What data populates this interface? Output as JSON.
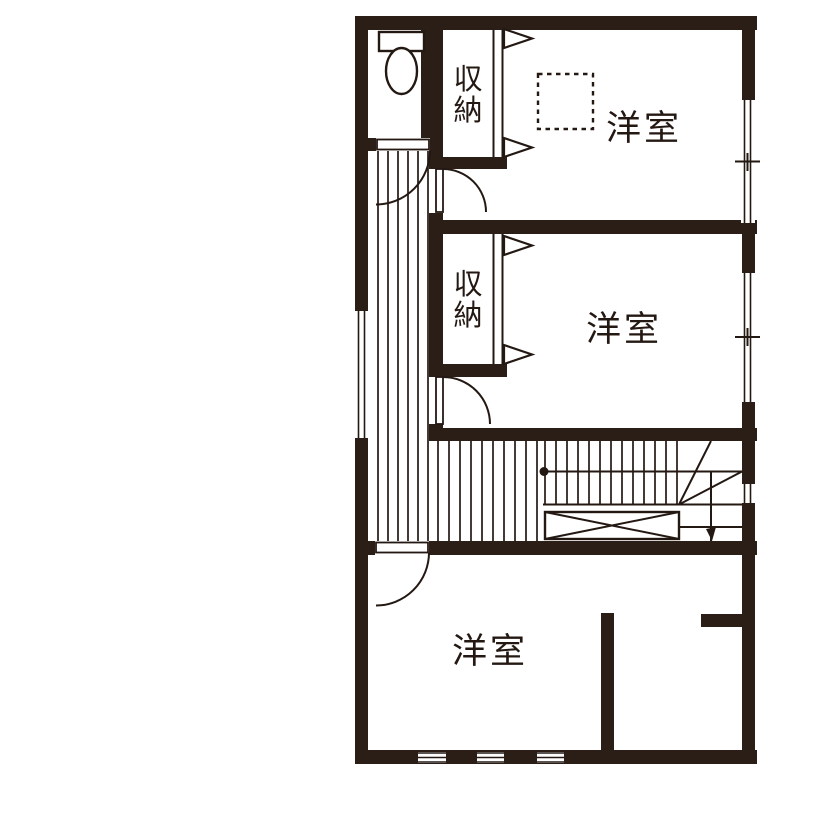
{
  "colors": {
    "wall": "#2b1e16",
    "line": "#241813",
    "background": "#ffffff"
  },
  "rooms": {
    "bedroom_top": {
      "label": "洋室"
    },
    "bedroom_middle": {
      "label": "洋室"
    },
    "bedroom_bottom": {
      "label": "洋室"
    },
    "closet_top": {
      "label": "収納",
      "chars": [
        "収",
        "納"
      ]
    },
    "closet_middle": {
      "label": "収納",
      "chars": [
        "収",
        "納"
      ]
    }
  }
}
